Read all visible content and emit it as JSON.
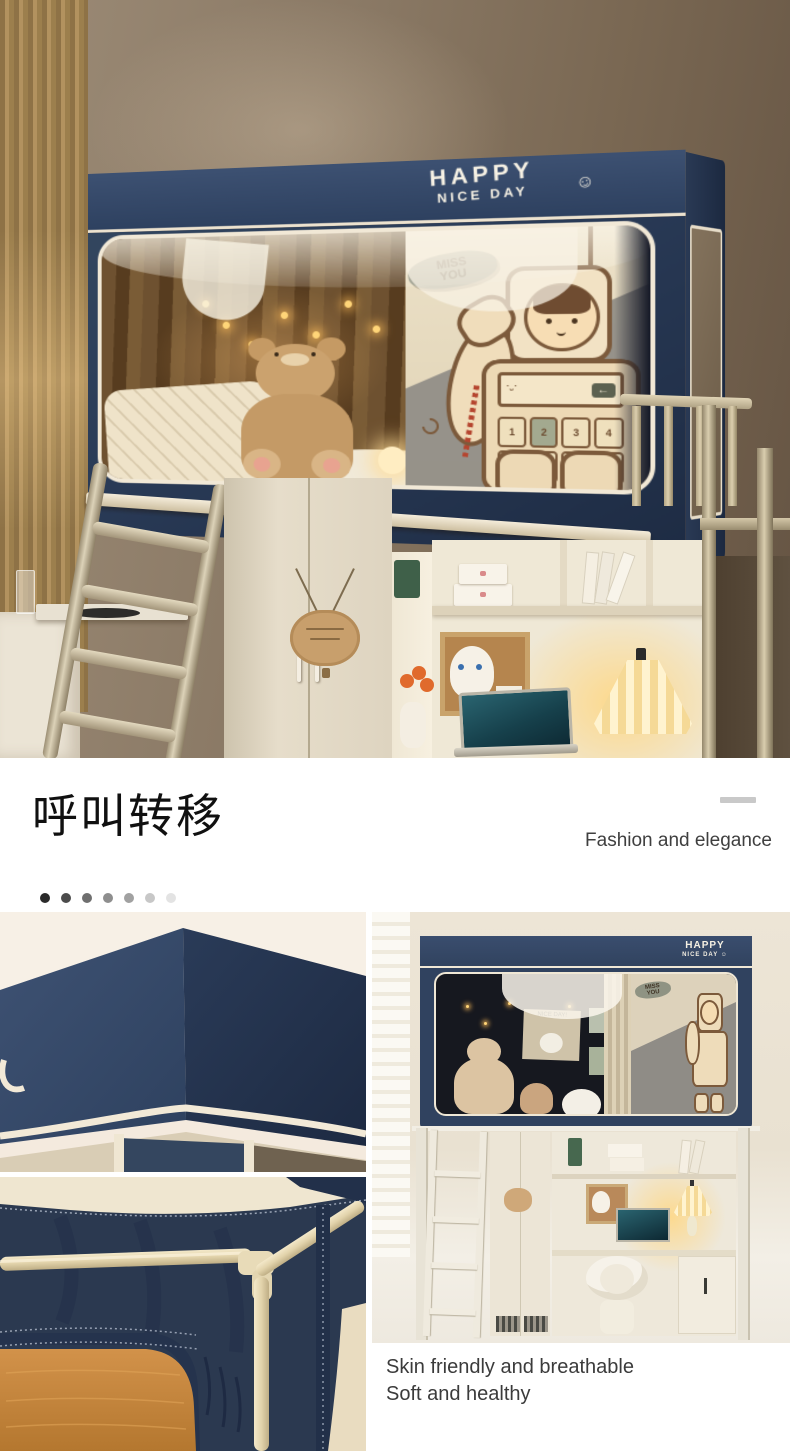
{
  "hero": {
    "canopy_print": {
      "line1": "HAPPY",
      "line2": "NICE DAY",
      "smiley": "☺"
    },
    "curtain_art": {
      "bubble_line1": "MISS",
      "bubble_line2": "YOU",
      "back_key": "←",
      "keypad_row1": [
        "1",
        "2",
        "3",
        "4"
      ],
      "keypad_row2": [
        "m",
        "c",
        "%",
        "="
      ]
    }
  },
  "divider": {
    "heading": "呼叫转移",
    "tagline": "Fashion and elegance",
    "pager_dots": [
      "#2a2a2a",
      "#4b4b4b",
      "#6f6f6f",
      "#8e8e8e",
      "#a1a1a1",
      "#c7c7c7",
      "#e3e3e3"
    ]
  },
  "room": {
    "canopy_print": {
      "line1": "HAPPY",
      "line2": "NICE DAY ☺"
    },
    "bubble_line1": "MISS",
    "bubble_line2": "YOU",
    "banner_text": "NICE DAY!",
    "caption_line1": "Skin friendly and breathable",
    "caption_line2": "Soft and healthy"
  },
  "colors": {
    "canopy_navy": "#2e4160",
    "canopy_navy_dark": "#1e2c44",
    "piping_cream": "#f1e8d6",
    "frame_champagne": "#cfc0a0",
    "wall_taupe": "#8b7a66",
    "mattress_orange": "#c9893f",
    "lamp_glow": "#ffd98c"
  }
}
